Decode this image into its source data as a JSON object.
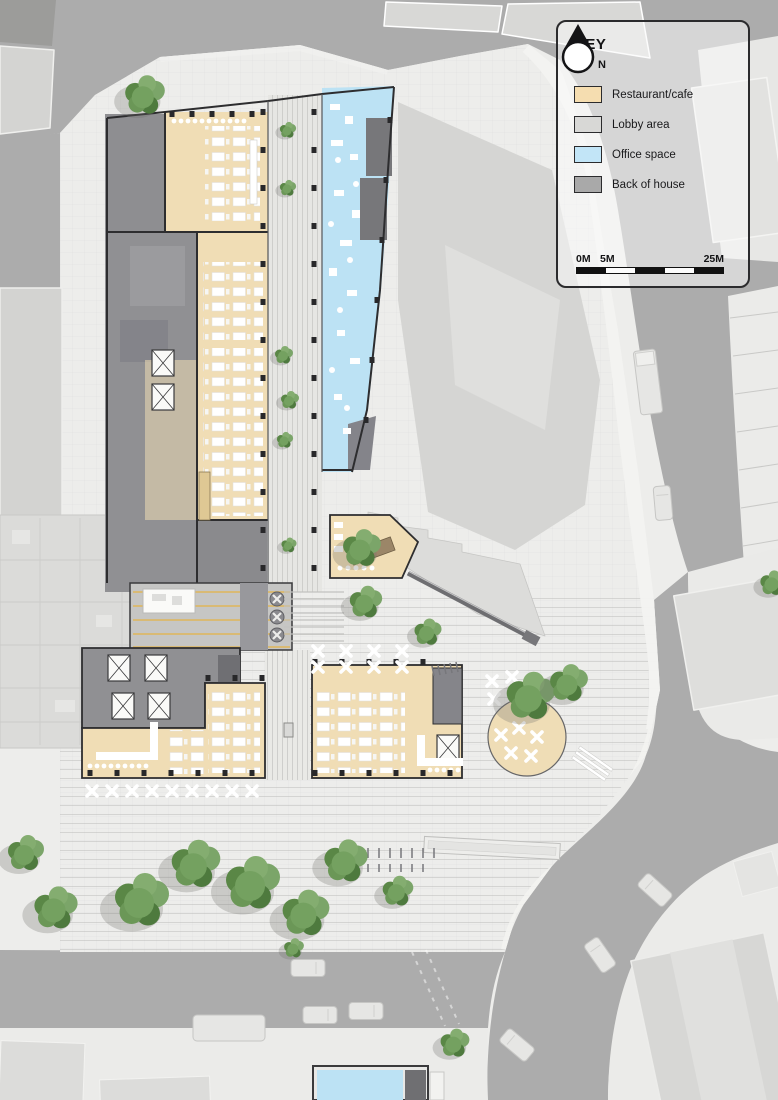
{
  "legend": {
    "title": "KEY",
    "compass_label": "N",
    "items": [
      {
        "label": "Restaurant/cafe",
        "color": "#F5DDB0"
      },
      {
        "label": "Lobby area",
        "color": "#D8D8D6"
      },
      {
        "label": "Office space",
        "color": "#C2E5F7"
      },
      {
        "label": "Back of house",
        "color": "#A9A9A9"
      }
    ],
    "scale_bar": {
      "labels": [
        "0M",
        "5M",
        "25M"
      ],
      "total_m": 25,
      "pattern": [
        "dark",
        "light",
        "dark",
        "light",
        "dark"
      ]
    }
  },
  "map": {
    "colors": {
      "road": "#ACACAC",
      "paving": "#EDEDEB",
      "restaurant_cafe": "#F0DDB5",
      "office_space": "#BCE2F4",
      "back_of_house": "#8E8E91",
      "adjacent_building": "#D5D5D3",
      "tree_canopy": "#6B9757",
      "wall_line": "#2D2D2F"
    }
  }
}
